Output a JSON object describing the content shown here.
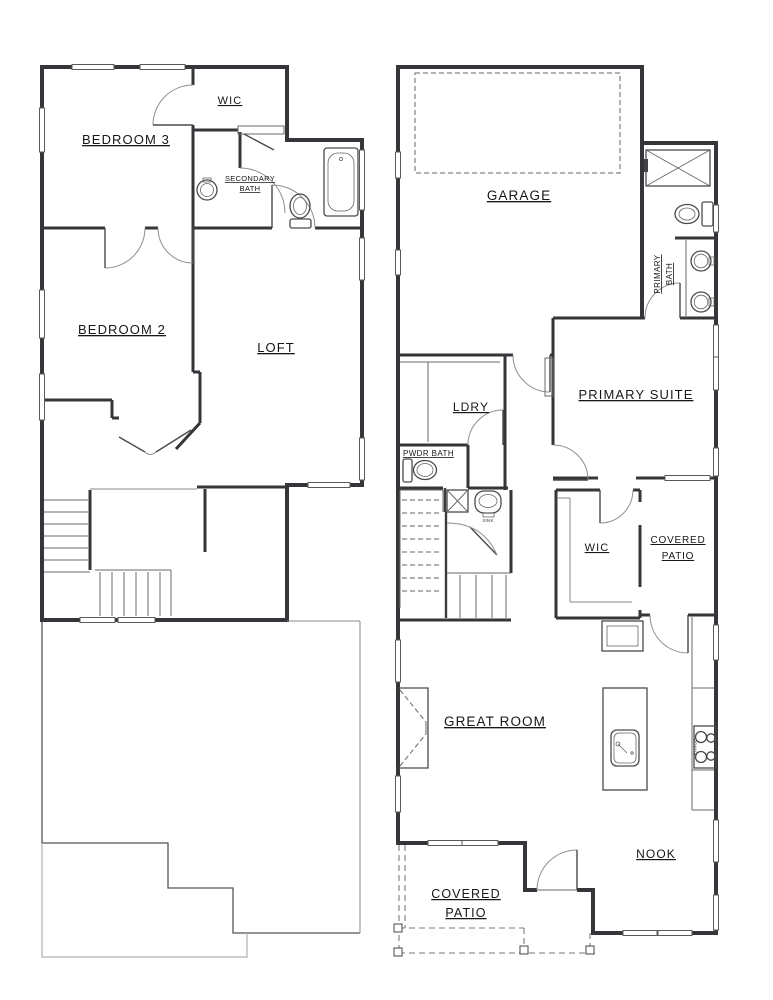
{
  "document": {
    "type": "residential floor plan, two stacked plans side by side",
    "background_color": "#ffffff",
    "wall_color": "#35353a",
    "outline_color": "#55555a",
    "slab_color": "#b0b0b0"
  },
  "upper_floor": {
    "bedroom3": "BEDROOM 3",
    "wic": "WIC",
    "secondary_bath_line1": "SECONDARY",
    "secondary_bath_line2": "BATH",
    "bedroom2": "BEDROOM 2",
    "loft": "LOFT"
  },
  "main_floor": {
    "garage": "GARAGE",
    "primary_bath_line1": "PRIMARY",
    "primary_bath_line2": "BATH",
    "primary_suite": "PRIMARY SUITE",
    "laundry": "LDRY",
    "powder_bath": "PWDR BATH",
    "sink": "SINK",
    "wic": "WIC",
    "covered_patio_upper_line1": "COVERED",
    "covered_patio_upper_line2": "PATIO",
    "great_room": "GREAT ROOM",
    "range": "RANGE",
    "nook": "NOOK",
    "covered_patio_lower_line1": "COVERED",
    "covered_patio_lower_line2": "PATIO"
  }
}
